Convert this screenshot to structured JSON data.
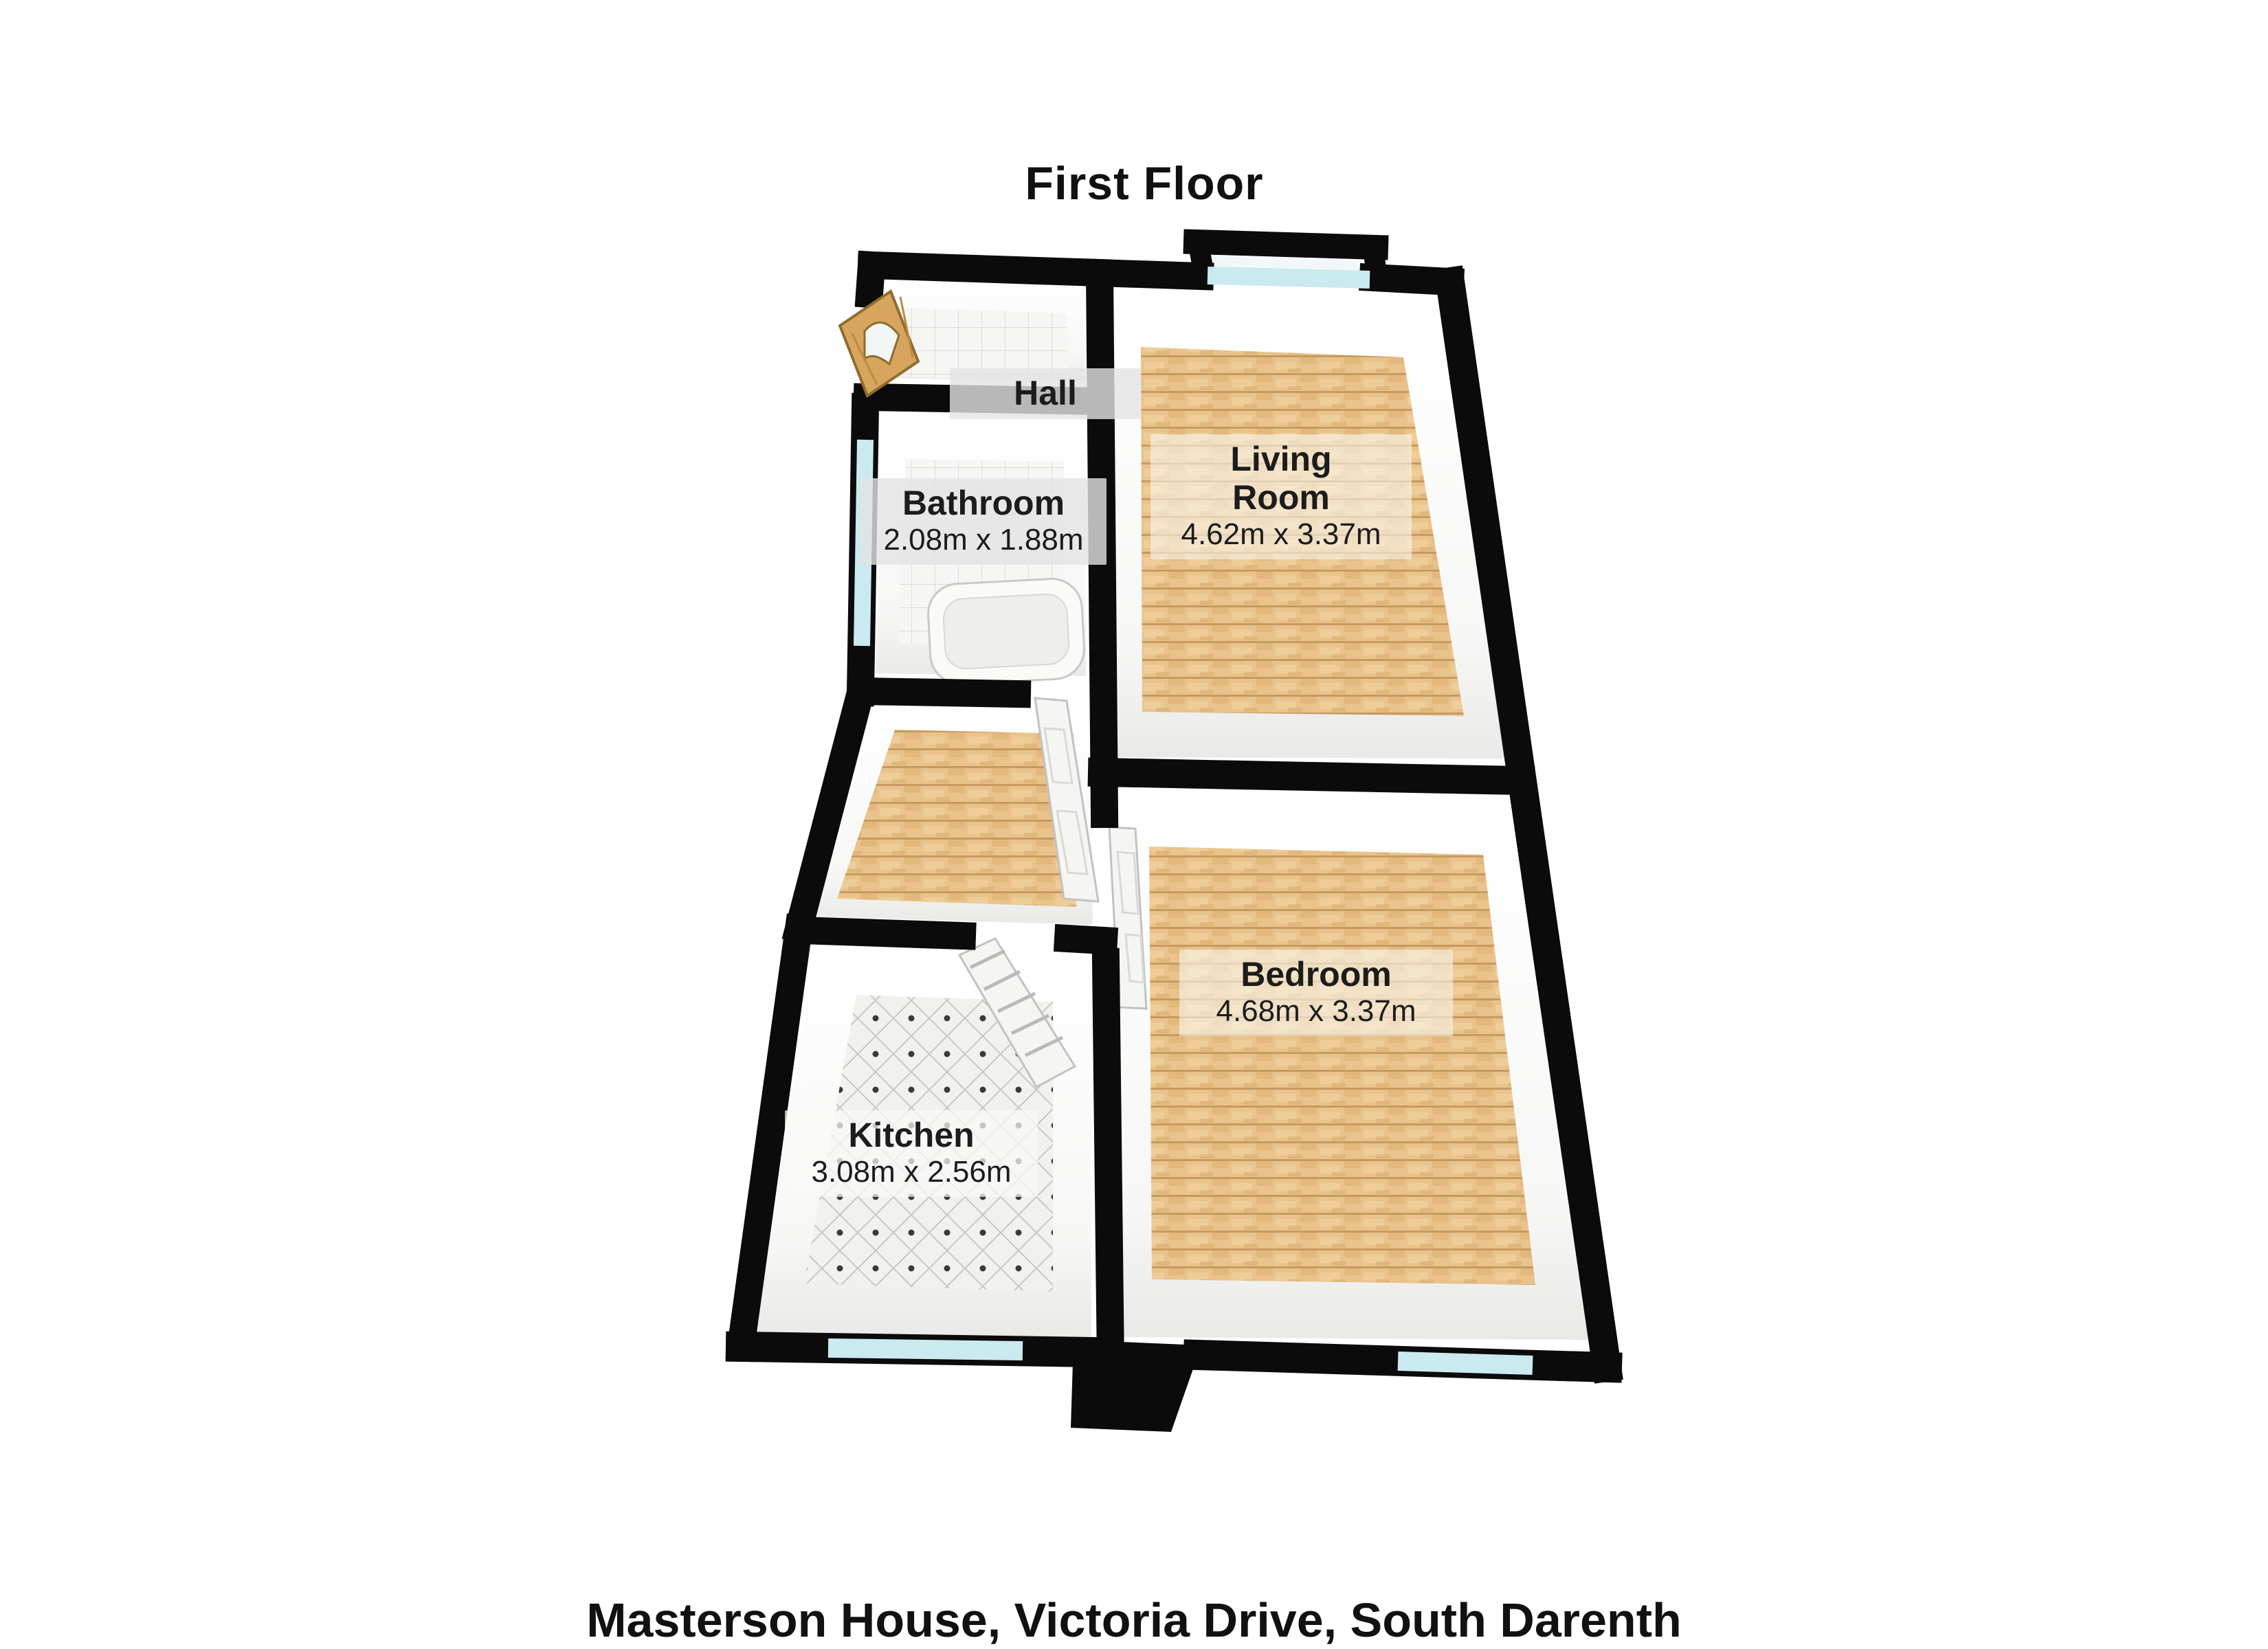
{
  "title": "First Floor",
  "footer_address": "Masterson House, Victoria Drive, South Darenth",
  "rooms": {
    "hall": {
      "name": "Hall",
      "floor": "white-tile"
    },
    "bathroom": {
      "name": "Bathroom",
      "dimensions": "2.08m x 1.88m",
      "floor": "white-tile"
    },
    "living_room": {
      "name": "Living Room",
      "name_line1": "Living",
      "name_line2": "Room",
      "dimensions": "4.62m x 3.37m",
      "floor": "wood"
    },
    "bedroom": {
      "name": "Bedroom",
      "dimensions": "4.68m x 3.37m",
      "floor": "wood"
    },
    "kitchen": {
      "name": "Kitchen",
      "dimensions": "3.08m x 2.56m",
      "floor": "diamond-tile"
    }
  },
  "colors": {
    "wall": "#0b0b0b",
    "wood_floor": "#e8c28a",
    "tile_floor": "#f4f4f2",
    "window_glass": "#cbeaef",
    "entrance_door": "#d8a55e",
    "label_text": "#1c1c1c"
  }
}
